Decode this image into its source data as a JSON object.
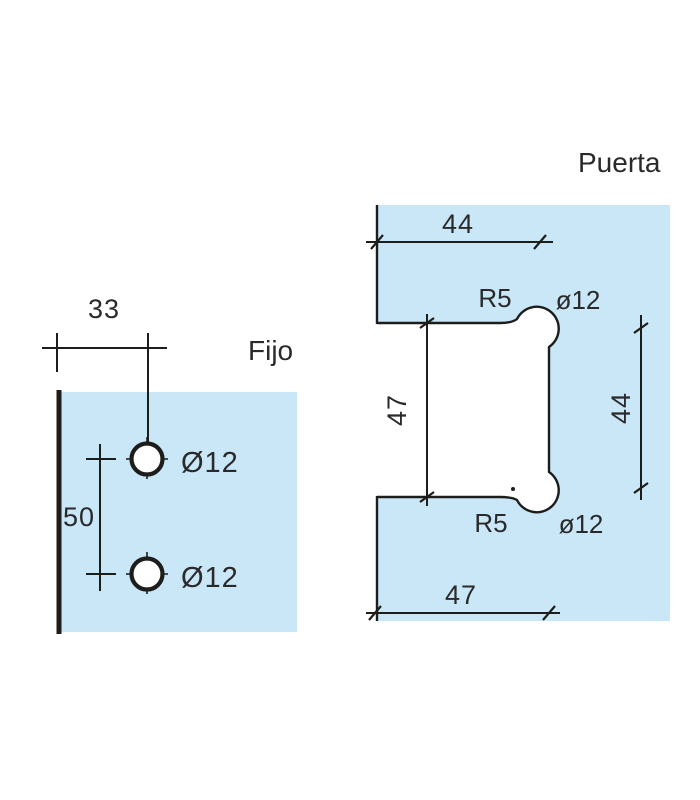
{
  "drawing_title": "Glass hinge drilling template",
  "colors": {
    "glass_blue": "#cae7f8",
    "line": "#1d1d1b",
    "text": "#2a2a2a"
  },
  "fijo": {
    "title": "Fijo",
    "edge_offset_dim": "33",
    "holes_spacing_dim": "50",
    "hole_top_label": "Ø12",
    "hole_bottom_label": "Ø12"
  },
  "puerta": {
    "title": "Puerta",
    "top_width_dim": "44",
    "notch_height_dim": "47",
    "holes_spacing_dim": "44",
    "bottom_width_dim": "47",
    "radius_top_label": "R5",
    "radius_bottom_label": "R5",
    "hole_top_label": "ø12",
    "hole_bottom_label": "ø12"
  }
}
